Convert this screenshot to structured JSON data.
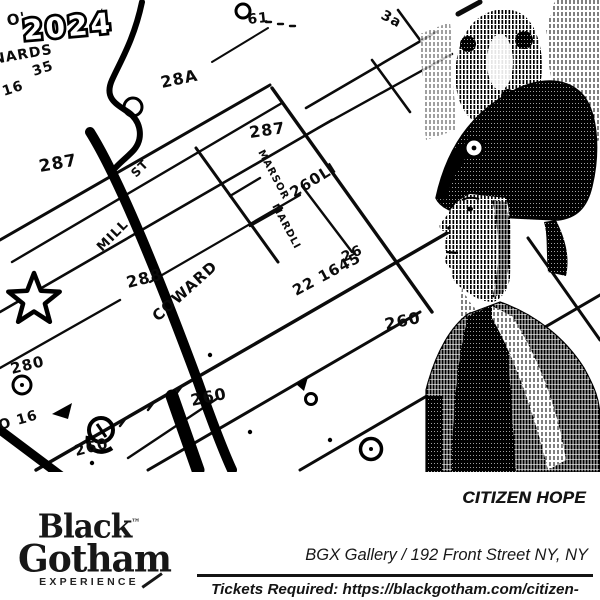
{
  "year_badge": "2024",
  "map": {
    "description_icon": "hand-drawn-historic-lot-map",
    "labels": [
      {
        "t": "O'",
        "x": 8,
        "y": 26,
        "s": 15,
        "r": -12
      },
      {
        "t": "NARDS",
        "x": -6,
        "y": 64,
        "s": 14,
        "r": -10
      },
      {
        "t": "35",
        "x": 34,
        "y": 76,
        "s": 14,
        "r": -18
      },
      {
        "t": "16",
        "x": 4,
        "y": 96,
        "s": 14,
        "r": -18
      },
      {
        "t": "61",
        "x": 248,
        "y": 24,
        "s": 14,
        "r": -6
      },
      {
        "t": "3a",
        "x": 380,
        "y": 18,
        "s": 14,
        "r": 28
      },
      {
        "t": "28A",
        "x": 162,
        "y": 88,
        "s": 16,
        "r": -12
      },
      {
        "t": "287",
        "x": 40,
        "y": 172,
        "s": 17,
        "r": -10
      },
      {
        "t": "287",
        "x": 250,
        "y": 138,
        "s": 16,
        "r": -8
      },
      {
        "t": "ST",
        "x": 136,
        "y": 178,
        "s": 12,
        "r": -45
      },
      {
        "t": "MILL",
        "x": 102,
        "y": 252,
        "s": 13,
        "r": -45
      },
      {
        "t": "COWARD",
        "x": 158,
        "y": 322,
        "s": 15,
        "r": -42
      },
      {
        "t": "MARSOR",
        "x": 258,
        "y": 152,
        "s": 10,
        "r": 62
      },
      {
        "t": "260LI",
        "x": 294,
        "y": 198,
        "s": 15,
        "r": -32
      },
      {
        "t": "MARDLI",
        "x": 272,
        "y": 206,
        "s": 10,
        "r": 62
      },
      {
        "t": "26",
        "x": 344,
        "y": 262,
        "s": 14,
        "r": -24
      },
      {
        "t": "22 1645",
        "x": 296,
        "y": 296,
        "s": 15,
        "r": -28
      },
      {
        "t": "260",
        "x": 386,
        "y": 330,
        "s": 16,
        "r": -12
      },
      {
        "t": "288",
        "x": 128,
        "y": 288,
        "s": 16,
        "r": -14
      },
      {
        "t": "280",
        "x": 12,
        "y": 374,
        "s": 15,
        "r": -14
      },
      {
        "t": "O 16",
        "x": 0,
        "y": 430,
        "s": 14,
        "r": -16
      },
      {
        "t": "260",
        "x": 76,
        "y": 456,
        "s": 15,
        "r": -14
      },
      {
        "t": "260",
        "x": 192,
        "y": 406,
        "s": 16,
        "r": -12
      }
    ]
  },
  "portrait": {
    "icon_name": "halftone-portrait-figure-in-plumed-bicorn-hat"
  },
  "footer": {
    "event_title": "CITIZEN HOPE",
    "logo": {
      "black": "Black",
      "tm": "™",
      "gotham": "Gotham",
      "experience": "EXPERIENCE"
    },
    "venue": "BGX Gallery / 192 Front Street NY, NY",
    "tickets": "Tickets Required: https://blackgotham.com/citizen-hope/"
  },
  "colors": {
    "ink": "#0b0b0b",
    "paper": "#ffffff"
  }
}
